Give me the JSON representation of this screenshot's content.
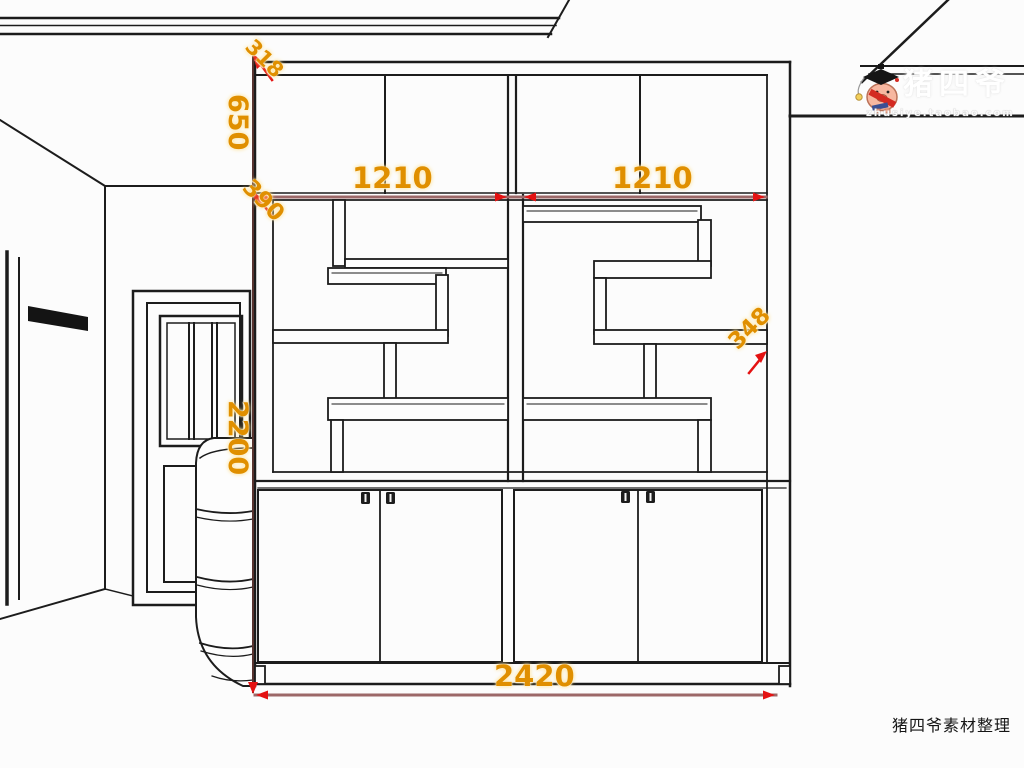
{
  "labels": {
    "dim_318": "318",
    "dim_650": "650",
    "dim_390": "390",
    "dim_1210_left": "1210",
    "dim_1210_right": "1210",
    "dim_348": "348",
    "dim_2200": "2200",
    "dim_2420": "2420"
  },
  "watermark": {
    "brand": "猪四爷",
    "url": "zhusiye.taobao.com"
  },
  "footer": {
    "credit": "猪四爷素材整理"
  },
  "colors": {
    "drawing_line": "#1c1c1c",
    "dimension_line_light": "#9c6868",
    "dimension_line_dark": "#57332f",
    "dimension_text": "#e08f00",
    "arrow_red": "#e41212",
    "pig_body": "#f7b7a0",
    "sash_red": "#d42a22",
    "medal_gold": "#f2cf5b"
  }
}
